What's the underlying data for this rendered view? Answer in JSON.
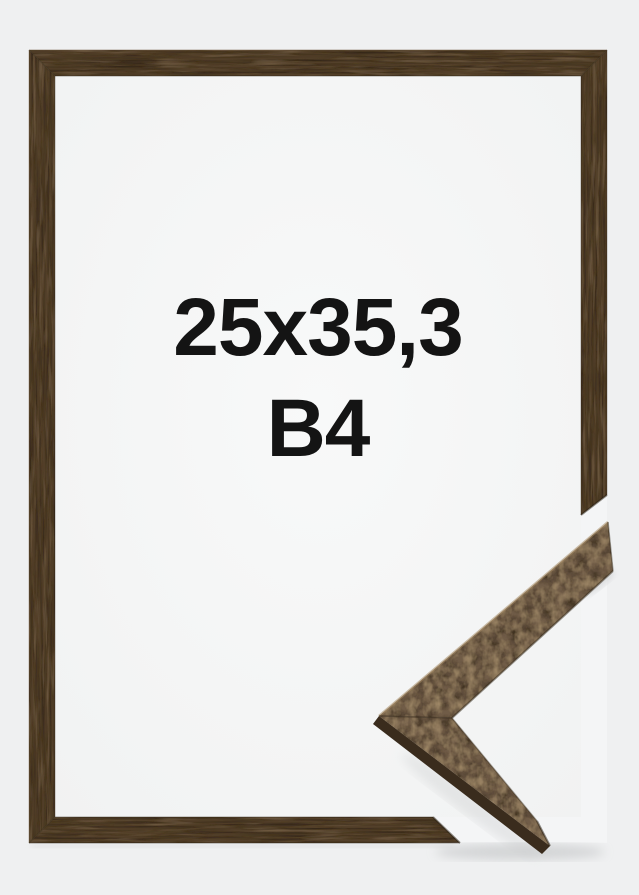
{
  "label": {
    "size": "25x35,3",
    "format": "B4"
  },
  "colors": {
    "background": "#eff0f1",
    "inside_center": "#f8f9f9",
    "inside_edge": "#f1f2f2",
    "cut_backdrop": "#f4f5f6",
    "frame_wood": "#53402c",
    "sample_wood": "#6f5c46",
    "sample_side": "#3a2c1d",
    "shadow": "#c7c9ca",
    "text": "#141414"
  }
}
